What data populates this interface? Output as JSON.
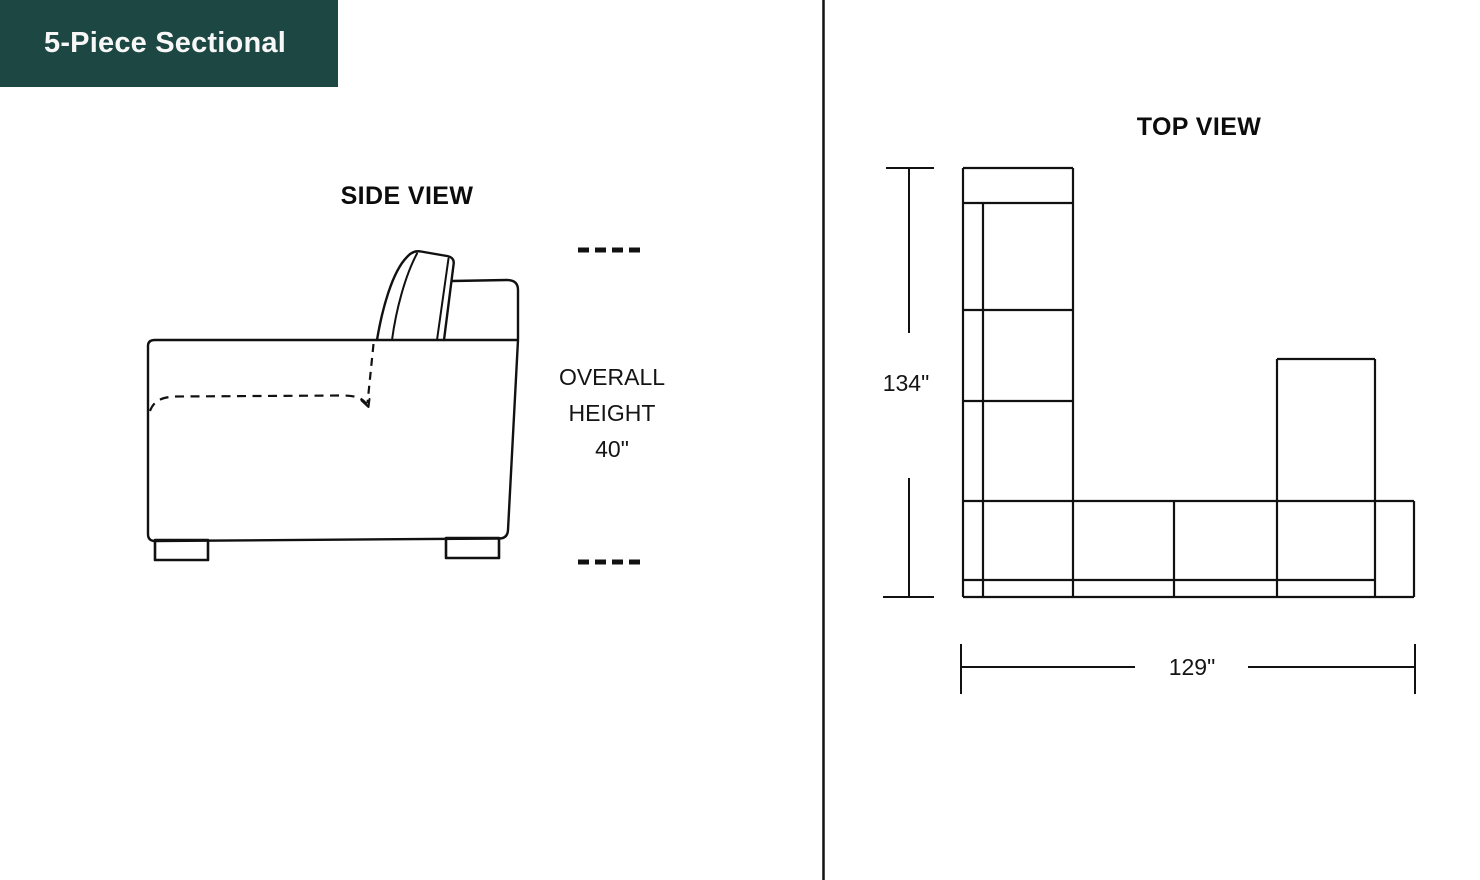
{
  "badge": {
    "label": "5-Piece Sectional"
  },
  "side_view": {
    "title": "SIDE VIEW",
    "annotation": {
      "line1": "OVERALL",
      "line2": "HEIGHT",
      "line3": "40\""
    }
  },
  "top_view": {
    "title": "TOP VIEW",
    "height_dimension": "134\"",
    "width_dimension": "129\""
  },
  "colors": {
    "badge_background": "#1d4743",
    "badge_text": "#f7f7f7",
    "line": "#111111",
    "page_background": "#ffffff"
  }
}
